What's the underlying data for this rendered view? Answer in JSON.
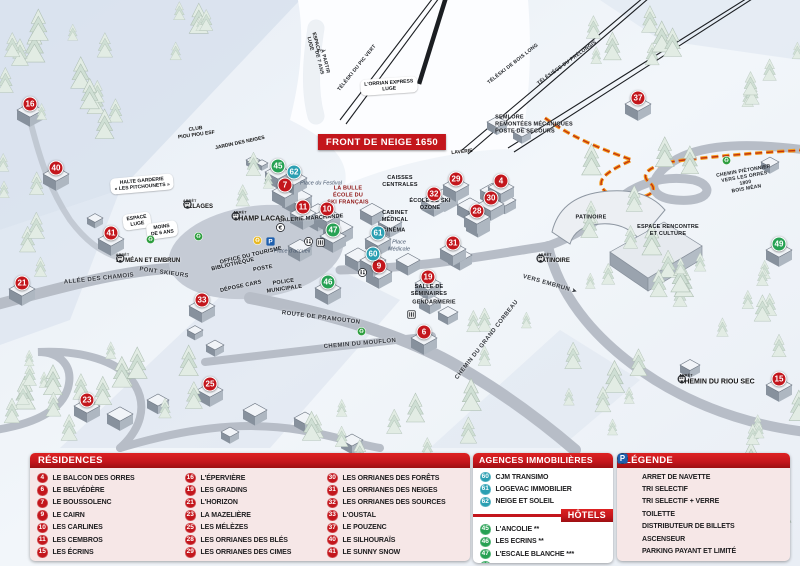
{
  "colors": {
    "red": "#c3161c",
    "teal": "#2b9fb2",
    "green": "#27a153",
    "panel": "#f6e7e7",
    "parking": "#1e5fae"
  },
  "map": {
    "banner": "FRONT DE NEIGE 1650",
    "arret_word": "ARRÊT",
    "markers": [
      {
        "n": "16",
        "t": "res",
        "x": 30,
        "y": 104
      },
      {
        "n": "40",
        "t": "res",
        "x": 56,
        "y": 168
      },
      {
        "n": "41",
        "t": "res",
        "x": 111,
        "y": 233
      },
      {
        "n": "21",
        "t": "res",
        "x": 22,
        "y": 283
      },
      {
        "n": "7",
        "t": "res",
        "x": 285,
        "y": 185
      },
      {
        "n": "11",
        "t": "res",
        "x": 303,
        "y": 207
      },
      {
        "n": "10",
        "t": "res",
        "x": 327,
        "y": 209
      },
      {
        "n": "29",
        "t": "res",
        "x": 456,
        "y": 179
      },
      {
        "n": "4",
        "t": "res",
        "x": 501,
        "y": 181
      },
      {
        "n": "32",
        "t": "res",
        "x": 434,
        "y": 194
      },
      {
        "n": "30",
        "t": "res",
        "x": 491,
        "y": 198
      },
      {
        "n": "28",
        "t": "res",
        "x": 477,
        "y": 211
      },
      {
        "n": "31",
        "t": "res",
        "x": 453,
        "y": 243
      },
      {
        "n": "9",
        "t": "res",
        "x": 379,
        "y": 266
      },
      {
        "n": "19",
        "t": "res",
        "x": 428,
        "y": 277
      },
      {
        "n": "6",
        "t": "res",
        "x": 424,
        "y": 332
      },
      {
        "n": "33",
        "t": "res",
        "x": 202,
        "y": 300
      },
      {
        "n": "25",
        "t": "res",
        "x": 210,
        "y": 384
      },
      {
        "n": "23",
        "t": "res",
        "x": 87,
        "y": 400
      },
      {
        "n": "37",
        "t": "res",
        "x": 638,
        "y": 98
      },
      {
        "n": "15",
        "t": "res",
        "x": 779,
        "y": 379
      },
      {
        "n": "62",
        "t": "agency",
        "x": 294,
        "y": 172
      },
      {
        "n": "61",
        "t": "agency",
        "x": 378,
        "y": 233
      },
      {
        "n": "60",
        "t": "agency",
        "x": 373,
        "y": 254
      },
      {
        "n": "45",
        "t": "hotel",
        "x": 278,
        "y": 166
      },
      {
        "n": "47",
        "t": "hotel",
        "x": 333,
        "y": 230
      },
      {
        "n": "46",
        "t": "hotel",
        "x": 328,
        "y": 282
      },
      {
        "n": "49",
        "t": "hotel",
        "x": 779,
        "y": 244
      }
    ],
    "labels": [
      {
        "t": "L'ORRIAN EXPRESS\nLUGE",
        "x": 389,
        "y": 86,
        "r": -4,
        "c": "pill"
      },
      {
        "t": "ESPACE\nLUGE",
        "x": 313,
        "y": 43,
        "r": 76,
        "c": "tinyb"
      },
      {
        "t": "À PARTIR\nDE 7 ANS",
        "x": 322,
        "y": 62,
        "r": 76,
        "c": "tiny"
      },
      {
        "t": "TÉLÉSKI DU PIC VERT",
        "x": 357,
        "y": 68,
        "r": -51,
        "c": "tiny"
      },
      {
        "t": "TÉLÉSKI DE BOIS LONG",
        "x": 513,
        "y": 64,
        "r": -38,
        "c": "tiny"
      },
      {
        "t": "TÉLÉSIÈGE DU PRÉLONGIS",
        "x": 567,
        "y": 63,
        "r": -36,
        "c": "tiny"
      },
      {
        "t": "SEMLORE\nREMONTÉES MÉCANIQUES\nPOSTE DE SECOURS",
        "x": 534,
        "y": 125,
        "r": 0,
        "c": "bld left"
      },
      {
        "t": "CLUB\nPIOU PIOU ESF",
        "x": 196,
        "y": 132,
        "r": -8,
        "c": "tinyb"
      },
      {
        "t": "JARDIN DES NEIGES",
        "x": 240,
        "y": 143,
        "r": -12,
        "c": "tinyb"
      },
      {
        "t": "HALTE GARDERIE\n« LES PITCHOUNETS »",
        "x": 142,
        "y": 184,
        "r": -5,
        "c": "pill"
      },
      {
        "t": "ESPACE\nLUGE",
        "x": 137,
        "y": 221,
        "r": -8,
        "c": "pill"
      },
      {
        "t": "MOINS\nDE 6 ANS",
        "x": 162,
        "y": 230,
        "r": -8,
        "c": "pill"
      },
      {
        "t": "CAISSES\nCENTRALES",
        "x": 400,
        "y": 182,
        "r": 0,
        "c": "bld"
      },
      {
        "t": "LA BULLE\nÉCOLE DU\nSKI FRANÇAIS",
        "x": 348,
        "y": 196,
        "r": 0,
        "c": "bld esf"
      },
      {
        "t": "Place du Festival",
        "x": 321,
        "y": 184,
        "r": 0,
        "c": "place"
      },
      {
        "t": "GALERIE MARCHANDE",
        "x": 311,
        "y": 219,
        "r": -4,
        "c": "bld"
      },
      {
        "t": "CABINET\nMÉDICAL",
        "x": 395,
        "y": 217,
        "r": 0,
        "c": "bld"
      },
      {
        "t": "CINÉMA",
        "x": 394,
        "y": 231,
        "r": 0,
        "c": "bld"
      },
      {
        "t": "Place\nMédicale",
        "x": 399,
        "y": 246,
        "r": 0,
        "c": "place"
      },
      {
        "t": "ÉCOLE DE SKI\nOZONE",
        "x": 430,
        "y": 205,
        "r": 0,
        "c": "bld"
      },
      {
        "t": "LAVERIE",
        "x": 462,
        "y": 152,
        "r": -6,
        "c": "tinyb"
      },
      {
        "t": "SALLE DE\nSÉMINAIRES",
        "x": 429,
        "y": 291,
        "r": 0,
        "c": "bld"
      },
      {
        "t": "GENDARMERIE",
        "x": 434,
        "y": 303,
        "r": 0,
        "c": "bld"
      },
      {
        "t": "POLICE\nMUNICIPALE",
        "x": 284,
        "y": 286,
        "r": -8,
        "c": "bld"
      },
      {
        "t": "BIBLIOTHÈQUE",
        "x": 233,
        "y": 265,
        "r": -13,
        "c": "bld"
      },
      {
        "t": "OFFICE DU TOURISME",
        "x": 251,
        "y": 256,
        "r": -13,
        "c": "bld"
      },
      {
        "t": "POSTE",
        "x": 263,
        "y": 269,
        "r": -10,
        "c": "bld"
      },
      {
        "t": "DÉPOSE CARS",
        "x": 241,
        "y": 287,
        "r": -12,
        "c": "bld"
      },
      {
        "t": "Place d'accueil",
        "x": 292,
        "y": 252,
        "r": 0,
        "c": "place"
      },
      {
        "t": "PATINOIRE",
        "x": 591,
        "y": 218,
        "r": 0,
        "c": "bld"
      },
      {
        "t": "ESPACE RENCONTRE\nET CULTURE",
        "x": 668,
        "y": 231,
        "r": 0,
        "c": "bld"
      },
      {
        "t": "ALLÉE DES CHAMOIS",
        "x": 99,
        "y": 279,
        "r": -6,
        "c": "road"
      },
      {
        "t": "PONT SKIEURS",
        "x": 164,
        "y": 273,
        "r": 8,
        "c": "road"
      },
      {
        "t": "ROUTE DE PRAMOUTON",
        "x": 321,
        "y": 318,
        "r": 7,
        "c": "road"
      },
      {
        "t": "CHEMIN DU MOUFLON",
        "x": 360,
        "y": 344,
        "r": -5,
        "c": "road"
      },
      {
        "t": "CHEMIN DU GRAND CORBEAU",
        "x": 487,
        "y": 340,
        "r": -52,
        "c": "road"
      },
      {
        "t": "VERS EMBRUN ➤",
        "x": 550,
        "y": 284,
        "r": 16,
        "c": "road"
      },
      {
        "t": "CHEMIN PIÉTONNIER\nVERS LES ORRES 1800\nBOIS MÉAN",
        "x": 745,
        "y": 180,
        "r": -10,
        "c": "tiny"
      }
    ],
    "bus_stops": [
      {
        "name": "VILLAGES",
        "x": 199,
        "y": 205,
        "icon": "right",
        "big": false
      },
      {
        "name": "CHAMP LACAS",
        "x": 258,
        "y": 217,
        "icon": "left",
        "big": true
      },
      {
        "name": "ST MÉAN ET EMBRUN",
        "x": 149,
        "y": 259,
        "icon": "right",
        "big": false
      },
      {
        "name": "PATINOIRE",
        "x": 553,
        "y": 259,
        "icon": "left",
        "big": false
      },
      {
        "name": "CHEMIN DU RIOU SEC",
        "x": 716,
        "y": 380,
        "icon": "left",
        "big": true
      }
    ],
    "icons": [
      {
        "k": "rec-g",
        "x": 146,
        "y": 235
      },
      {
        "k": "rec-g",
        "x": 194,
        "y": 232
      },
      {
        "k": "rec-g",
        "x": 357,
        "y": 327
      },
      {
        "k": "rec-g",
        "x": 722,
        "y": 156
      },
      {
        "k": "rec-y",
        "x": 253,
        "y": 236
      },
      {
        "k": "park",
        "x": 266,
        "y": 237
      },
      {
        "k": "euro",
        "x": 276,
        "y": 223
      },
      {
        "k": "wc",
        "x": 304,
        "y": 237
      },
      {
        "k": "asc",
        "x": 316,
        "y": 238
      },
      {
        "k": "wc",
        "x": 358,
        "y": 268
      },
      {
        "k": "asc",
        "x": 407,
        "y": 310
      }
    ]
  },
  "legend": {
    "residences": {
      "title": "RÉSIDENCES",
      "items": [
        {
          "n": "4",
          "label": "LE BALCON DES ORRES"
        },
        {
          "n": "6",
          "label": "LE BELVÉDÈRE"
        },
        {
          "n": "7",
          "label": "LE BOUSSOLENC"
        },
        {
          "n": "9",
          "label": "LE CAIRN"
        },
        {
          "n": "10",
          "label": "LES CARLINES"
        },
        {
          "n": "11",
          "label": "LES CEMBROS"
        },
        {
          "n": "15",
          "label": "LES ÉCRINS"
        },
        {
          "n": "16",
          "label": "L'ÉPERVIÈRE"
        },
        {
          "n": "19",
          "label": "LES GRADINS"
        },
        {
          "n": "21",
          "label": "L'HORIZON"
        },
        {
          "n": "23",
          "label": "LA MAZELIÈRE"
        },
        {
          "n": "25",
          "label": "LES MÉLÈZES"
        },
        {
          "n": "28",
          "label": "LES ORRIANES DES BLÉS"
        },
        {
          "n": "29",
          "label": "LES ORRIANES DES CIMES"
        },
        {
          "n": "30",
          "label": "LES ORRIANES DES FORÊTS"
        },
        {
          "n": "31",
          "label": "LES ORRIANES DES NEIGES"
        },
        {
          "n": "32",
          "label": "LES ORRIANES DES SOURCES"
        },
        {
          "n": "33",
          "label": "L'OUSTAL"
        },
        {
          "n": "37",
          "label": "LE POUZENC"
        },
        {
          "n": "40",
          "label": "LE SILHOURAÏS"
        },
        {
          "n": "41",
          "label": "LE SUNNY SNOW"
        }
      ]
    },
    "agences": {
      "title": "AGENCES IMMOBILIÈRES",
      "items": [
        {
          "n": "60",
          "label": "CJM TRANSIMO"
        },
        {
          "n": "61",
          "label": "LOGEVAC IMMOBILIER"
        },
        {
          "n": "62",
          "label": "NEIGE ET SOLEIL"
        }
      ]
    },
    "hotels": {
      "title": "HÔTELS",
      "items": [
        {
          "n": "45",
          "label": "L'ANCOLIE **"
        },
        {
          "n": "46",
          "label": "LES ECRINS **"
        },
        {
          "n": "47",
          "label": "L'ESCALE BLANCHE ***"
        },
        {
          "n": "49",
          "label": "LES TRAPPEURS **"
        }
      ]
    },
    "legende": {
      "title": "LÉGENDE",
      "items": [
        {
          "k": "bus",
          "label": "ARRET DE NAVETTE"
        },
        {
          "k": "rec-g",
          "label": "TRI SELECTIF"
        },
        {
          "k": "rec-y",
          "label": "TRI SELECTIF + VERRE"
        },
        {
          "k": "wc",
          "label": "TOILETTE"
        },
        {
          "k": "euro",
          "label": "DISTRIBUTEUR DE BILLETS"
        },
        {
          "k": "asc",
          "label": "ASCENSEUR"
        },
        {
          "k": "park",
          "label": "PARKING PAYANT ET LIMITÉ"
        }
      ]
    }
  }
}
